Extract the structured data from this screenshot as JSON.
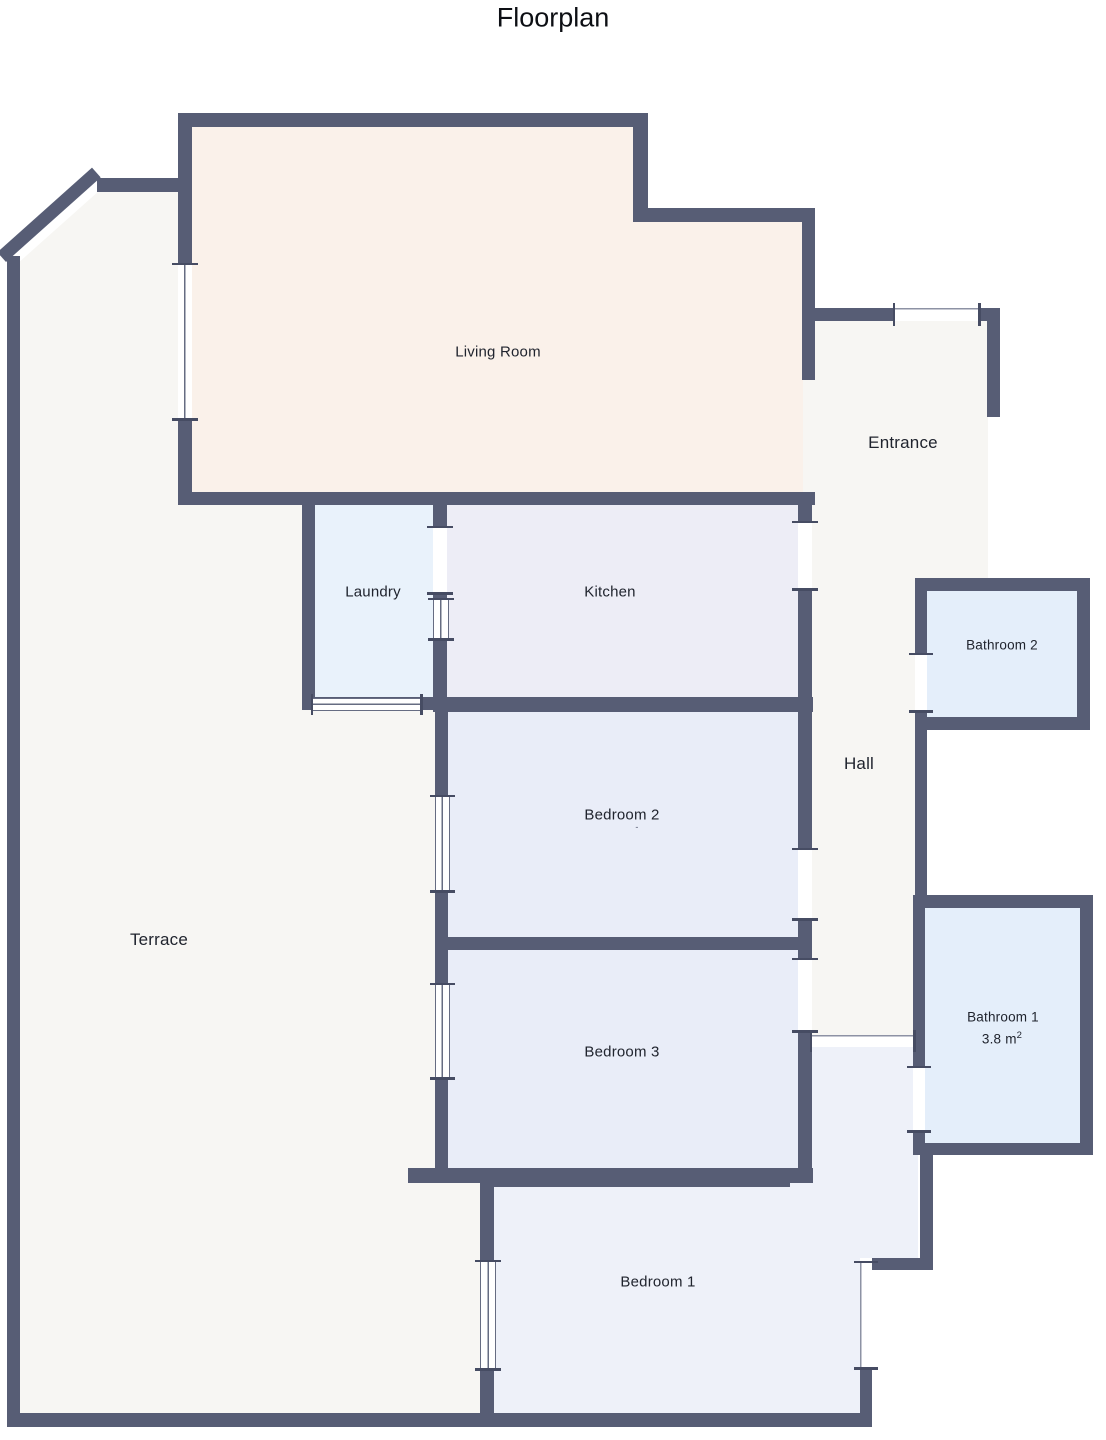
{
  "page": {
    "title": "Floorplan"
  },
  "palette": {
    "wall": "#575d75",
    "living": "#faf1ea",
    "outdoor": "#f7f6f3",
    "laundry": "#e9f2fb",
    "kitchen": "#ededf6",
    "bedroom": "#e9edf8",
    "bedroom1": "#eef1f9",
    "bathroom": "#e4eefa"
  },
  "rooms": {
    "living_room": {
      "label": "Living Room"
    },
    "entrance": {
      "label": "Entrance"
    },
    "hall": {
      "label": "Hall"
    },
    "laundry": {
      "label": "Laundry"
    },
    "kitchen": {
      "label": "Kitchen"
    },
    "bathroom2": {
      "label": "Bathroom 2"
    },
    "bedroom2": {
      "label": "Bedroom 2",
      "note": "-"
    },
    "terrace": {
      "label": "Terrace"
    },
    "bedroom3": {
      "label": "Bedroom 3"
    },
    "bathroom1": {
      "label": "Bathroom 1",
      "area_value": "3.8 m",
      "area_sup": "2"
    },
    "bedroom1": {
      "label": "Bedroom 1"
    }
  }
}
